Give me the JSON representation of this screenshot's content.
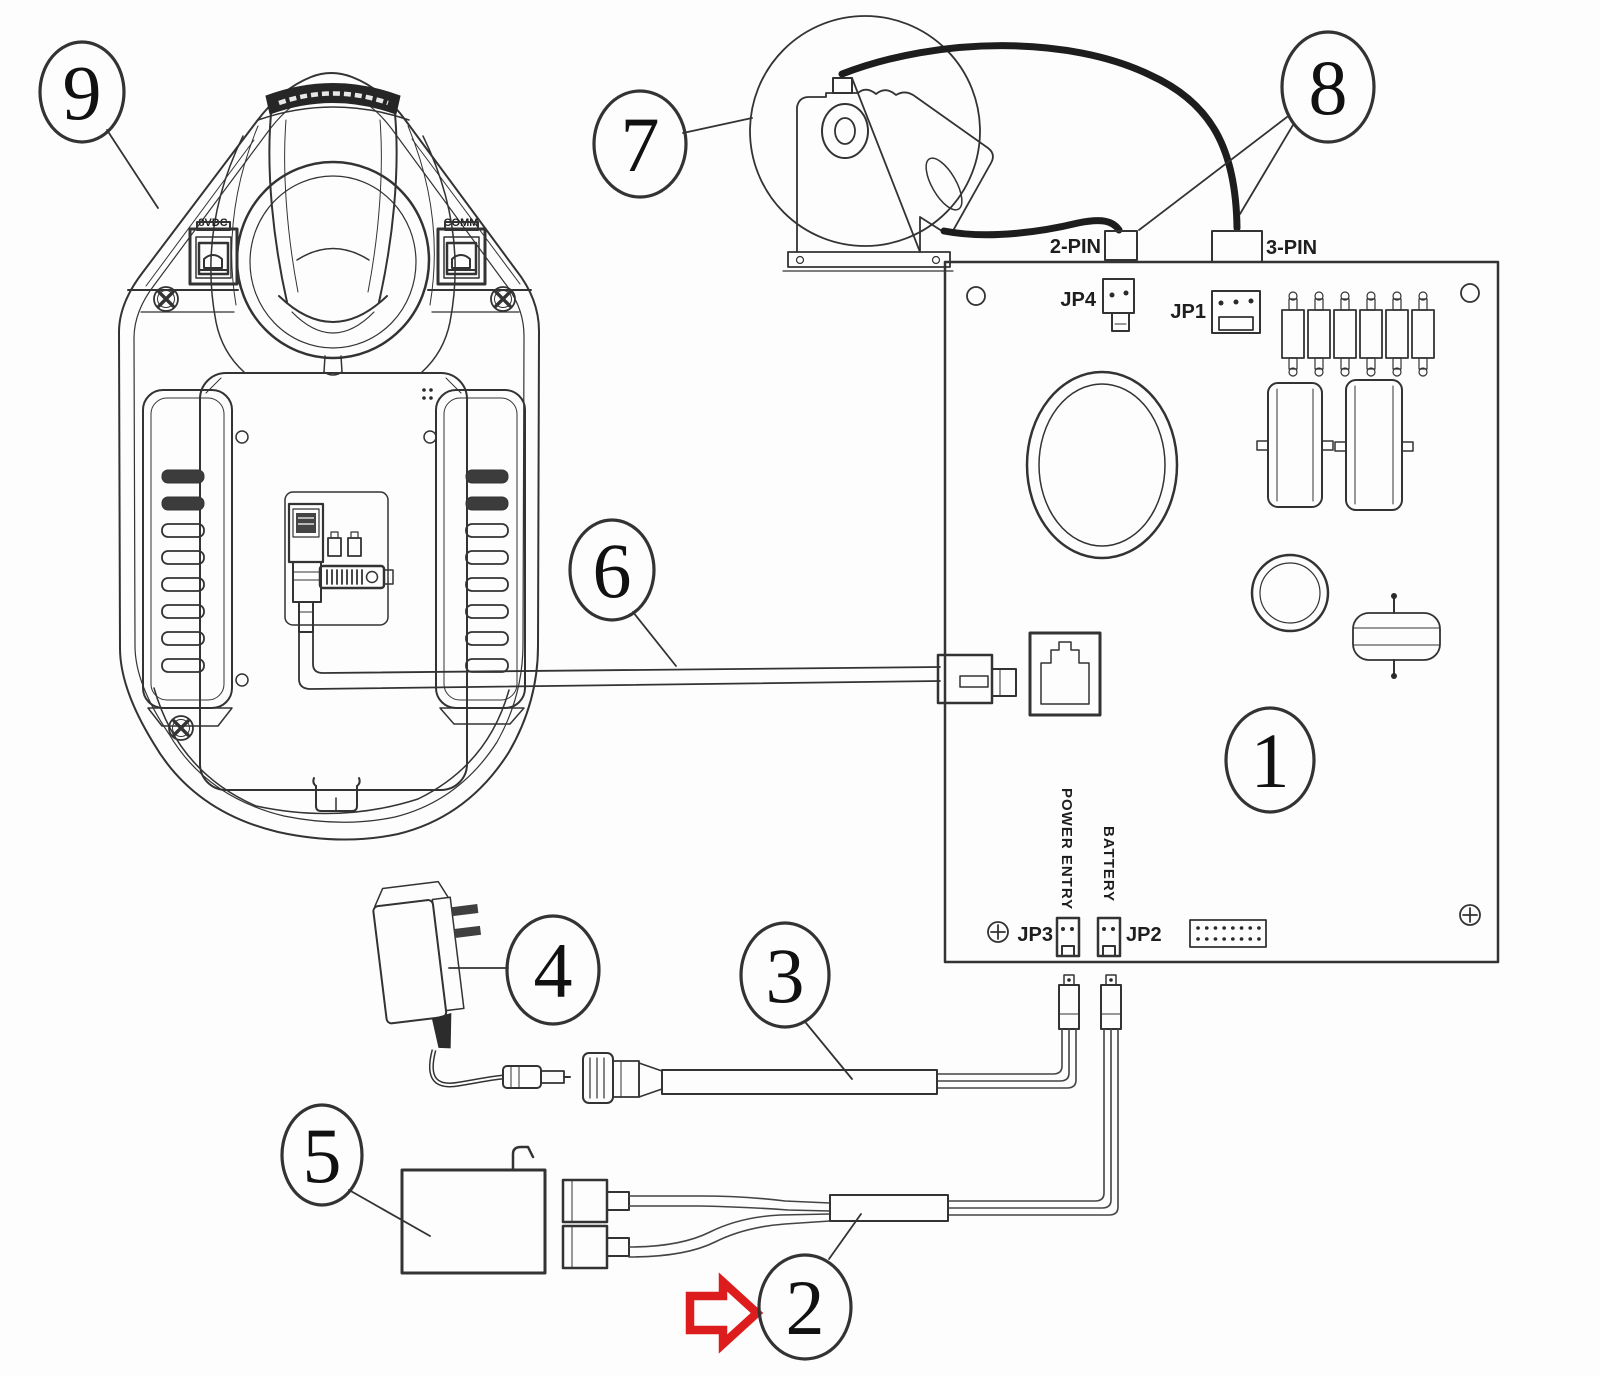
{
  "board": {
    "callout": "1",
    "jp1": "JP1",
    "jp2": "JP2",
    "jp3": "JP3",
    "jp4": "JP4",
    "two_pin": "2-PIN",
    "three_pin": "3-PIN",
    "power_entry": "POWER ENTRY",
    "battery": "BATTERY"
  },
  "cradle": {
    "callout": "9",
    "left_port": "8VDC",
    "right_port": "COMM"
  },
  "callouts": {
    "battery_harness": "2",
    "power_cable": "3",
    "ac_adapter": "4",
    "battery_pack": "5",
    "comm_cable": "6",
    "motor": "7",
    "motor_connectors": "8"
  },
  "colors": {
    "ink": "#333333",
    "arrow_red": "#dd1d1d",
    "paper": "#fdfdfd"
  }
}
